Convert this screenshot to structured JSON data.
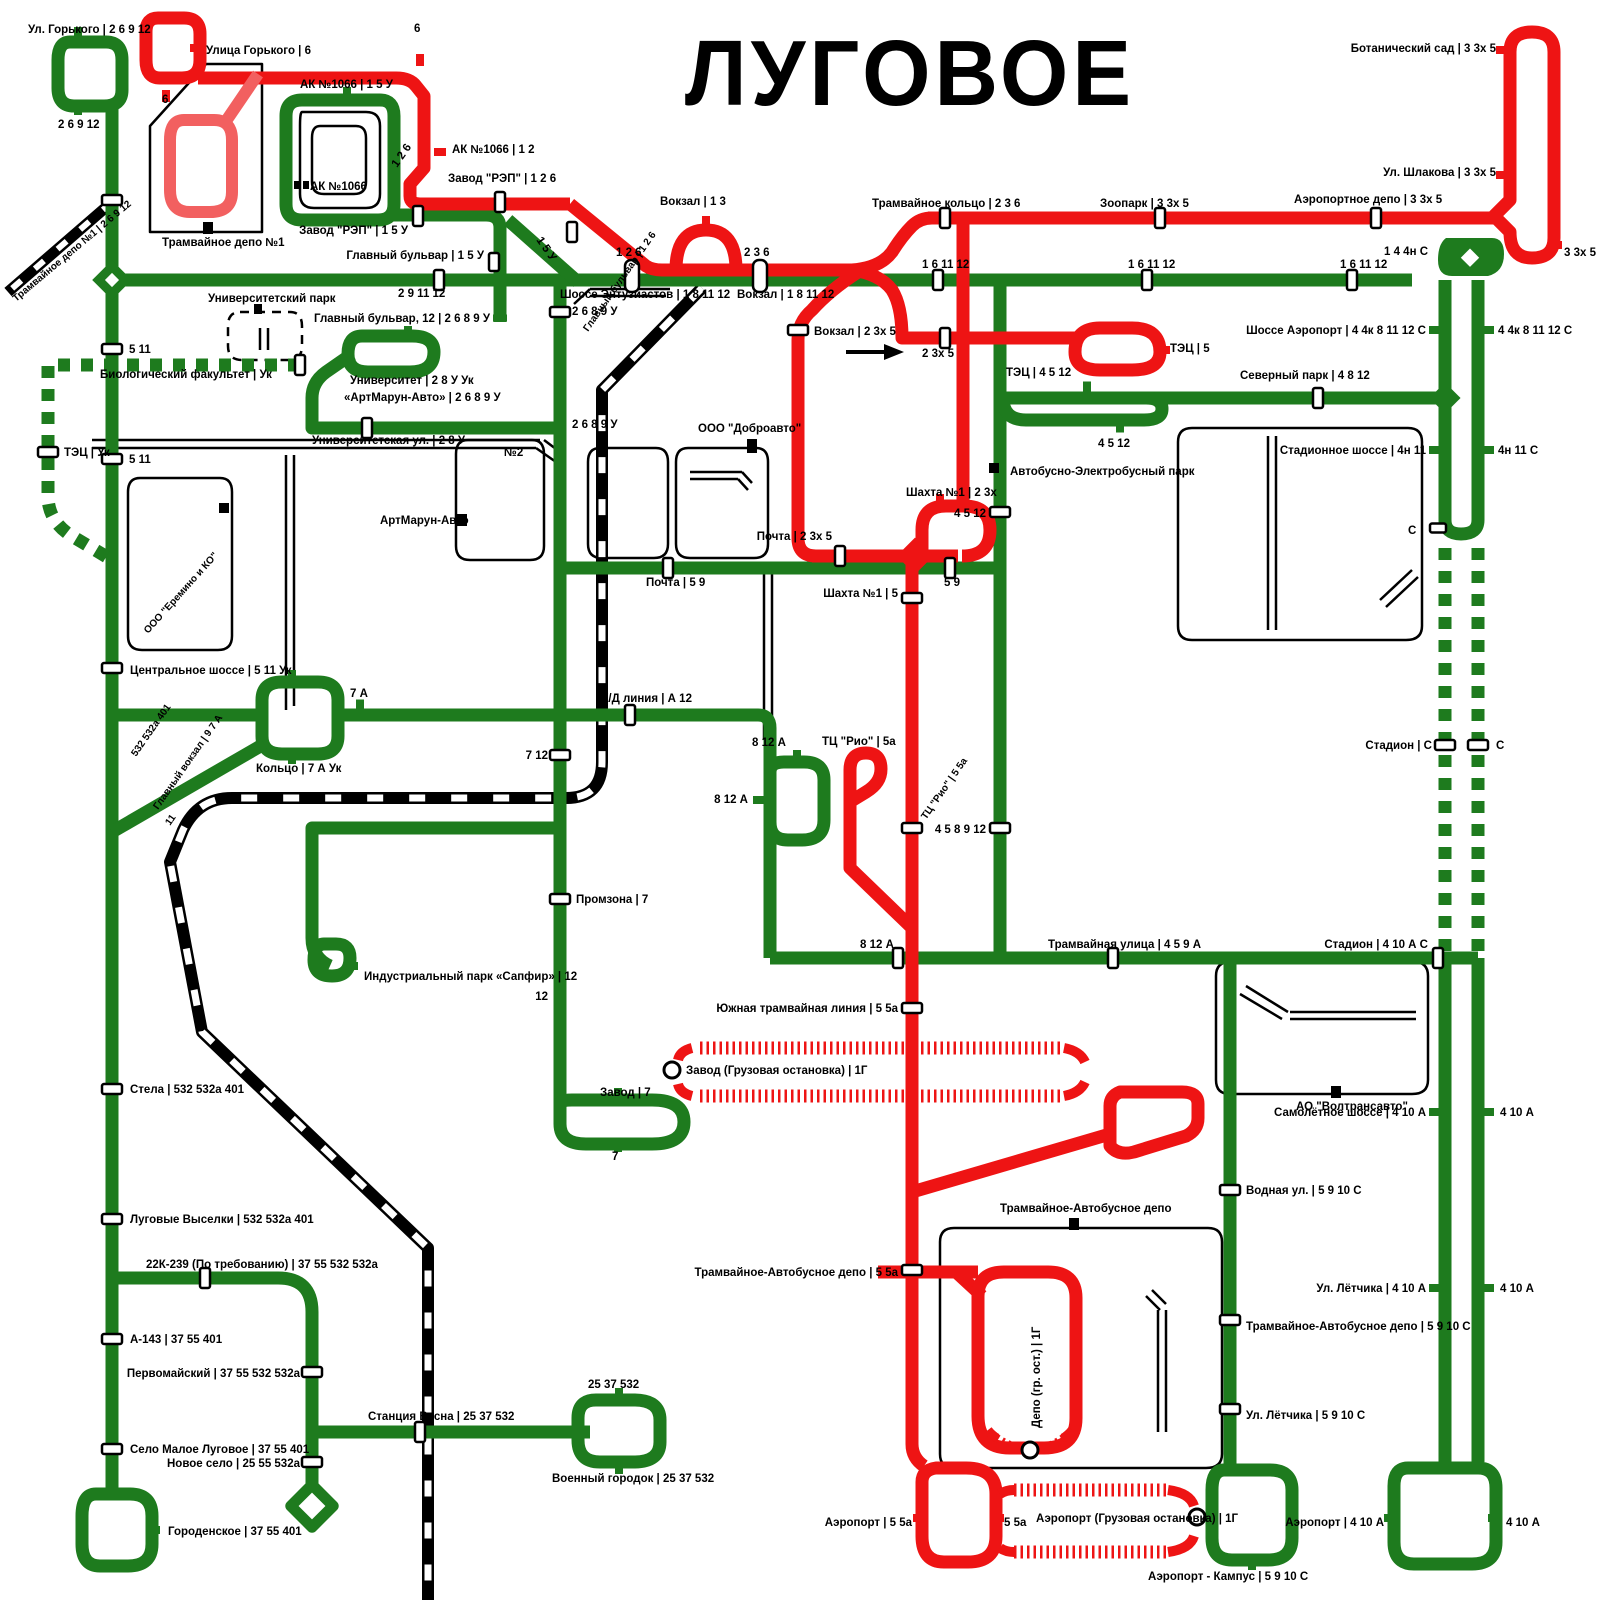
{
  "title": "ЛУГОВОЕ",
  "colors": {
    "bus_green": "#1e7b1e",
    "tram_red": "#ee1414",
    "depot_light_red": "#f26060",
    "rail_black": "#000000",
    "stop_fill": "#ffffff"
  },
  "labels": [
    {
      "id": "ul-gorkogo",
      "t": "Ул. Горького | 2 6 9 12",
      "x": 28,
      "y": 33
    },
    {
      "id": "num-26912",
      "t": "2 6 9 12",
      "x": 58,
      "y": 128
    },
    {
      "id": "ulitsa-gorkogo",
      "t": "Улица Горького | 6",
      "x": 206,
      "y": 54
    },
    {
      "id": "num-6",
      "t": "6",
      "x": 162,
      "y": 103
    },
    {
      "id": "num-6-top",
      "t": "6",
      "x": 414,
      "y": 32
    },
    {
      "id": "tram-depo1-diag",
      "t": "Трамвайное депо №1 | 2 6 9 12",
      "x": 16,
      "y": 302,
      "r": -40,
      "s": 10
    },
    {
      "id": "tram-depo1",
      "t": "Трамвайное депо №1",
      "x": 162,
      "y": 246
    },
    {
      "id": "ak1066-green",
      "t": "АК №1066 | 1 5 У",
      "x": 300,
      "y": 88
    },
    {
      "id": "ak1066-red",
      "t": "АК №1066 | 1 2",
      "x": 452,
      "y": 153
    },
    {
      "id": "ak1066-depot",
      "t": "АК №1066",
      "x": 310,
      "y": 190
    },
    {
      "id": "zavod-rep-red",
      "t": "Завод \"РЭП\" | 1 2 6",
      "x": 448,
      "y": 182
    },
    {
      "id": "zavod-rep-green",
      "t": "Завод \"РЭП\" | 1 5 У",
      "x": 408,
      "y": 234,
      "a": "end"
    },
    {
      "id": "glav-bulvar-green",
      "t": "Главный бульвар | 1 5 У",
      "x": 484,
      "y": 259,
      "a": "end"
    },
    {
      "id": "num-126-diag",
      "t": "1 2 6",
      "x": 397,
      "y": 168,
      "r": -55
    },
    {
      "id": "num-15u-diag",
      "t": "1 5 У",
      "x": 536,
      "y": 240,
      "r": 55
    },
    {
      "id": "glav-bulvar-red-diag",
      "t": "Главный бульвар | 1 2 6",
      "x": 588,
      "y": 332,
      "r": -55,
      "s": 10
    },
    {
      "id": "num-29-11-12",
      "t": "2 9 11 12",
      "x": 398,
      "y": 297
    },
    {
      "id": "univ-park",
      "t": "Университетский парк",
      "x": 208,
      "y": 302
    },
    {
      "id": "glav-bulvar-12",
      "t": "Главный бульвар, 12 | 2 6 8 9 У",
      "x": 490,
      "y": 322,
      "a": "end"
    },
    {
      "id": "num-2689u-a",
      "t": "2 6 8 9 У",
      "x": 572,
      "y": 315
    },
    {
      "id": "num-511-a",
      "t": "5 11",
      "x": 129,
      "y": 353
    },
    {
      "id": "biofak",
      "t": "Биологический факультет | Ук",
      "x": 100,
      "y": 378
    },
    {
      "id": "universitet",
      "t": "Университет | 2 8 У Ук",
      "x": 350,
      "y": 384
    },
    {
      "id": "artmarun-route",
      "t": "«АртМарун-Авто» | 2 6 8 9 У",
      "x": 344,
      "y": 401
    },
    {
      "id": "univ-ul",
      "t": "Университетская ул. | 2 8 У",
      "x": 312,
      "y": 444
    },
    {
      "id": "num-2689u-b",
      "t": "2 6 8 9 У",
      "x": 572,
      "y": 428
    },
    {
      "id": "num-511-b",
      "t": "5 11",
      "x": 129,
      "y": 463
    },
    {
      "id": "tec-uk",
      "t": "ТЭЦ | Ук",
      "x": 64,
      "y": 456
    },
    {
      "id": "no2",
      "t": "№2",
      "x": 504,
      "y": 456
    },
    {
      "id": "artmarun-depot",
      "t": "АртМарун-Авто",
      "x": 380,
      "y": 524
    },
    {
      "id": "dobroavto",
      "t": "ООО \"Доброавто\"",
      "x": 698,
      "y": 432
    },
    {
      "id": "eremino",
      "t": "ООО \"Еремино и КО\"",
      "x": 148,
      "y": 634,
      "r": -48,
      "s": 10
    },
    {
      "id": "centr-shosse",
      "t": "Центральное шоссе | 5 11 Ук",
      "x": 130,
      "y": 674
    },
    {
      "id": "vokzal-13",
      "t": "Вокзал | 1 3",
      "x": 660,
      "y": 205
    },
    {
      "id": "num-126",
      "t": "1 2 6",
      "x": 616,
      "y": 256
    },
    {
      "id": "num-236",
      "t": "2 3 6",
      "x": 744,
      "y": 256
    },
    {
      "id": "shosse-ent",
      "t": "Шоссе Энтузиастов | 1 8 11 12",
      "x": 560,
      "y": 298
    },
    {
      "id": "vokzal-181112",
      "t": "Вокзал | 1 8 11 12",
      "x": 737,
      "y": 298
    },
    {
      "id": "vokzal-23x5",
      "t": "Вокзал | 2 3х 5",
      "x": 814,
      "y": 335
    },
    {
      "id": "tram-kolco",
      "t": "Трамвайное кольцо | 2 3 6",
      "x": 872,
      "y": 207
    },
    {
      "id": "zoopark",
      "t": "Зоопарк | 3 3х 5",
      "x": 1100,
      "y": 207
    },
    {
      "id": "num-161112-a",
      "t": "1 6 11 12",
      "x": 922,
      "y": 268
    },
    {
      "id": "num-161112-b",
      "t": "1 6 11 12",
      "x": 1128,
      "y": 268
    },
    {
      "id": "num-161112-c",
      "t": "1 6 11 12",
      "x": 1340,
      "y": 268
    },
    {
      "id": "num-144nc",
      "t": "1 4 4н С",
      "x": 1384,
      "y": 255
    },
    {
      "id": "num-23x5",
      "t": "2 3х 5",
      "x": 922,
      "y": 357
    },
    {
      "id": "tec-5",
      "t": "ТЭЦ | 5",
      "x": 1170,
      "y": 352
    },
    {
      "id": "tec-4512",
      "t": "ТЭЦ | 4 5 12",
      "x": 1006,
      "y": 376
    },
    {
      "id": "botsad",
      "t": "Ботанический сад | 3 3х 5",
      "x": 1496,
      "y": 52,
      "a": "end"
    },
    {
      "id": "shlakova",
      "t": "Ул. Шлакова | 3 3х 5",
      "x": 1496,
      "y": 176,
      "a": "end"
    },
    {
      "id": "aeroportnoe-depo",
      "t": "Аэропортное депо | 3 3х 5",
      "x": 1294,
      "y": 203
    },
    {
      "id": "num-33x5",
      "t": "3 3х 5",
      "x": 1564,
      "y": 256
    },
    {
      "id": "shosse-aeroport",
      "t": "Шоссе Аэропорт | 4 4к 8 11 12 С",
      "x": 1426,
      "y": 334,
      "a": "end"
    },
    {
      "id": "num-44k",
      "t": "4 4к 8 11 12 С",
      "x": 1498,
      "y": 334
    },
    {
      "id": "severny-park",
      "t": "Северный парк | 4 8 12",
      "x": 1240,
      "y": 379
    },
    {
      "id": "autobus-park",
      "t": "Автобусно-Электробусный парк",
      "x": 1010,
      "y": 475
    },
    {
      "id": "num-4512-b",
      "t": "4 5 12",
      "x": 1098,
      "y": 447
    },
    {
      "id": "stadionnoe-shosse",
      "t": "Стадионное шоссе | 4н 11",
      "x": 1426,
      "y": 454,
      "a": "end"
    },
    {
      "id": "num-4n11c",
      "t": "4н 11 С",
      "x": 1498,
      "y": 454
    },
    {
      "id": "c-top",
      "t": "С",
      "x": 1408,
      "y": 534
    },
    {
      "id": "shahta-23x",
      "t": "Шахта №1 | 2 3х",
      "x": 906,
      "y": 496
    },
    {
      "id": "num-4512-c",
      "t": "4 5 12",
      "x": 986,
      "y": 517,
      "a": "end"
    },
    {
      "id": "pochta-23x5",
      "t": "Почта | 2 3х 5",
      "x": 832,
      "y": 540,
      "a": "end"
    },
    {
      "id": "pochta-59",
      "t": "Почта | 5 9",
      "x": 646,
      "y": 586
    },
    {
      "id": "num-59",
      "t": "5 9",
      "x": 944,
      "y": 586
    },
    {
      "id": "shahta-5",
      "t": "Шахта №1 | 5",
      "x": 898,
      "y": 597,
      "a": "end"
    },
    {
      "id": "zhd-linia",
      "t": "Ж/Д линия | А 12",
      "x": 598,
      "y": 702
    },
    {
      "id": "num-7a",
      "t": "7 А",
      "x": 350,
      "y": 697
    },
    {
      "id": "kolco",
      "t": "Кольцо | 7 А Ук",
      "x": 256,
      "y": 772
    },
    {
      "id": "num-532-diag",
      "t": "532 532а 401",
      "x": 136,
      "y": 757,
      "r": -55,
      "s": 10
    },
    {
      "id": "glav-vokzal-diag",
      "t": "Главный вокзал | 9 7 А",
      "x": 158,
      "y": 810,
      "r": -55,
      "s": 10
    },
    {
      "id": "num-11-diag",
      "t": "11",
      "x": 170,
      "y": 826,
      "r": -55,
      "s": 10
    },
    {
      "id": "num-712",
      "t": "7 12",
      "x": 548,
      "y": 759,
      "a": "end"
    },
    {
      "id": "num-812a-a",
      "t": "8 12 А",
      "x": 752,
      "y": 746
    },
    {
      "id": "num-812a-b",
      "t": "8 12 А",
      "x": 748,
      "y": 803,
      "a": "end"
    },
    {
      "id": "tc-rio-5a",
      "t": "ТЦ \"Рио\" | 5а",
      "x": 822,
      "y": 745
    },
    {
      "id": "tc-rio-55a",
      "t": "ТЦ \"Рио\" | 5 5а",
      "x": 926,
      "y": 820,
      "r": -55,
      "s": 10
    },
    {
      "id": "num-458912",
      "t": "4 5 8 9 12",
      "x": 986,
      "y": 833,
      "a": "end"
    },
    {
      "id": "stadion-c",
      "t": "Стадион | С",
      "x": 1432,
      "y": 749,
      "a": "end"
    },
    {
      "id": "c-right",
      "t": "С",
      "x": 1496,
      "y": 749
    },
    {
      "id": "num-812a-c",
      "t": "8 12 А",
      "x": 860,
      "y": 948
    },
    {
      "id": "tram-ulica",
      "t": "Трамвайная улица | 4 5 9 А",
      "x": 1048,
      "y": 948
    },
    {
      "id": "stadion-410",
      "t": "Стадион | 4 10 А С",
      "x": 1428,
      "y": 948,
      "a": "end"
    },
    {
      "id": "yuzhnaya",
      "t": "Южная трамвайная линия | 5 5а",
      "x": 898,
      "y": 1012,
      "a": "end"
    },
    {
      "id": "promzona",
      "t": "Промзона | 7",
      "x": 576,
      "y": 903
    },
    {
      "id": "num-12",
      "t": "12",
      "x": 548,
      "y": 1000,
      "a": "end"
    },
    {
      "id": "sapfir",
      "t": "Индустриальный парк «Сапфир» | 12",
      "x": 364,
      "y": 980
    },
    {
      "id": "zavod-gruz",
      "t": "Завод (Грузовая остановка) | 1Г",
      "x": 686,
      "y": 1074
    },
    {
      "id": "zavod-7",
      "t": "Завод | 7",
      "x": 600,
      "y": 1096
    },
    {
      "id": "num-7",
      "t": "7",
      "x": 612,
      "y": 1160
    },
    {
      "id": "stela",
      "t": "Стела | 532 532а 401",
      "x": 130,
      "y": 1093
    },
    {
      "id": "lugovye",
      "t": "Луговые Выселки | 532 532а 401",
      "x": 130,
      "y": 1223
    },
    {
      "id": "n22k",
      "t": "22К-239 (По требованию) | 37 55 532 532а",
      "x": 146,
      "y": 1268
    },
    {
      "id": "a143",
      "t": "А-143 | 37 55 401",
      "x": 130,
      "y": 1343
    },
    {
      "id": "pervomaisky",
      "t": "Первомайский | 37 55 532 532а",
      "x": 300,
      "y": 1377,
      "a": "end"
    },
    {
      "id": "selo-maloe",
      "t": "Село Малое Луговое | 37 55 401",
      "x": 130,
      "y": 1453
    },
    {
      "id": "novoe-selo",
      "t": "Новое село | 25 55 532а",
      "x": 300,
      "y": 1467,
      "a": "end"
    },
    {
      "id": "gorodenskoe",
      "t": "Городенское | 37 55 401",
      "x": 168,
      "y": 1535
    },
    {
      "id": "stancia-vesna",
      "t": "Станция Весна | 25 37 532",
      "x": 368,
      "y": 1420
    },
    {
      "id": "num-2537532",
      "t": "25 37 532",
      "x": 588,
      "y": 1388
    },
    {
      "id": "voenny",
      "t": "Военный городок | 25 37 532",
      "x": 552,
      "y": 1482
    },
    {
      "id": "voltransavto",
      "t": "АО \"Волтрансавто\"",
      "x": 1296,
      "y": 1110
    },
    {
      "id": "samolet",
      "t": "Самолётное шоссе | 4 10 А",
      "x": 1426,
      "y": 1116,
      "a": "end"
    },
    {
      "id": "num-410a-a",
      "t": "4 10 А",
      "x": 1500,
      "y": 1116
    },
    {
      "id": "vodnaya",
      "t": "Водная ул. | 5 9 10 С",
      "x": 1246,
      "y": 1194
    },
    {
      "id": "letchika-410",
      "t": "Ул. Лётчика | 4 10 А",
      "x": 1426,
      "y": 1292,
      "a": "end"
    },
    {
      "id": "num-410a-b",
      "t": "4 10 А",
      "x": 1500,
      "y": 1292
    },
    {
      "id": "tad-depot",
      "t": "Трамвайное-Автобусное депо",
      "x": 1000,
      "y": 1212
    },
    {
      "id": "tad-55a",
      "t": "Трамвайное-Автобусное депо | 5 5а",
      "x": 898,
      "y": 1276,
      "a": "end"
    },
    {
      "id": "tad-5910",
      "t": "Трамвайное-Автобусное депо | 5 9 10 С",
      "x": 1246,
      "y": 1330
    },
    {
      "id": "depo-gruz",
      "t": "Депо (гр. ост.) | 1Г",
      "x": 1040,
      "y": 1428,
      "r": -90
    },
    {
      "id": "letchika-5910",
      "t": "Ул. Лётчика | 5 9 10 С",
      "x": 1246,
      "y": 1419
    },
    {
      "id": "aeroport-55a",
      "t": "Аэропорт | 5 5а",
      "x": 912,
      "y": 1526,
      "a": "end"
    },
    {
      "id": "num-55a",
      "t": "5 5а",
      "x": 1004,
      "y": 1526
    },
    {
      "id": "aeroport-gruz",
      "t": "Аэропорт (Грузовая остановка) | 1Г",
      "x": 1036,
      "y": 1522
    },
    {
      "id": "kampus",
      "t": "Аэропорт - Кампус | 5 9 10 С",
      "x": 1148,
      "y": 1580
    },
    {
      "id": "aeroport-410",
      "t": "Аэропорт | 4 10 А",
      "x": 1384,
      "y": 1526,
      "a": "end"
    },
    {
      "id": "num-410a-c",
      "t": "4 10 А",
      "x": 1506,
      "y": 1526
    }
  ]
}
